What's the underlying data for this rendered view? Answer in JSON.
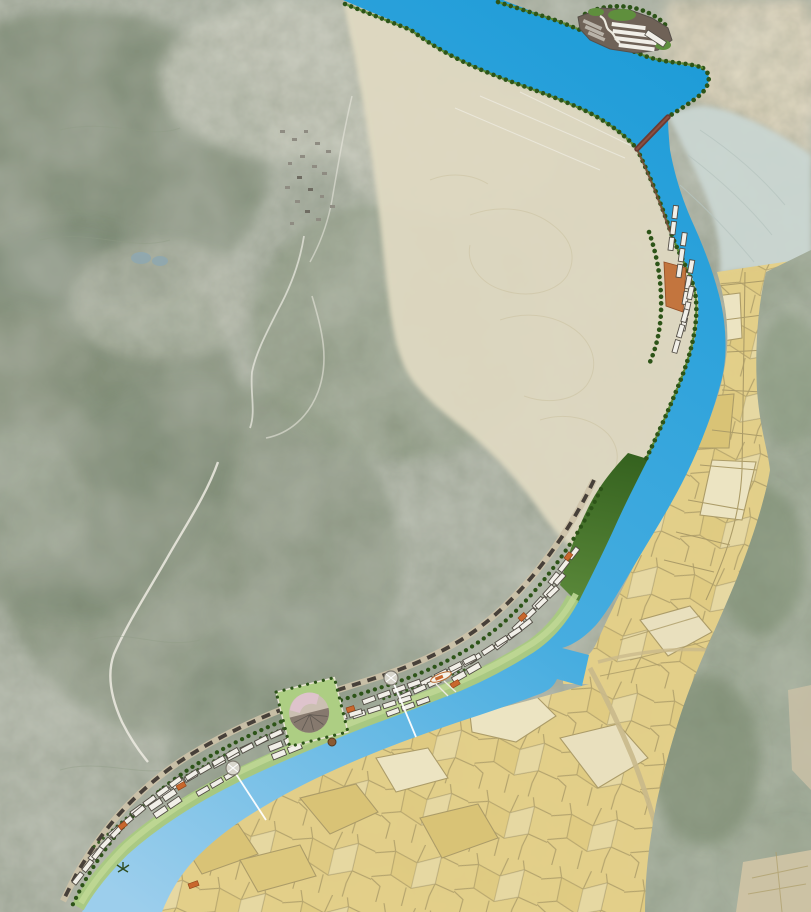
{
  "image_type": "aerial-masterplan-map",
  "description": "Aerial photo of mountainous river valley overlaid with a masterplan: reservoir and dam at top, river flowing southwest, tree-lined banks, a north lakeside settlement, a hillside cluster, a long linear waterfront town with central plaza, and yellow farmland/old-town parcels across the river",
  "water": {
    "reservoir": "reservoir",
    "river": "river channel",
    "inlet": "harbor inlet notch",
    "flow_direction": "north to southwest"
  },
  "features": {
    "structures": [
      "dam-crossing",
      "north-lakeside-settlement",
      "hillside-terrace-cluster",
      "linear-waterfront-town",
      "central-plaza-with-mound",
      "ferry-ship",
      "river-buoy",
      "waterfront-pier"
    ],
    "landscape": [
      "mountain-ridges",
      "hillside-village",
      "fish-ponds",
      "terraced-beige-fields",
      "pale-river-terraces",
      "farmland-parcels",
      "old-town-parcels",
      "shoreline-tree-lines",
      "riverbank-forest-band"
    ],
    "annotation": {
      "leader_lines": 2,
      "roundabout_nodes": 2,
      "leader_line_color": "#FFFFFF"
    }
  },
  "palette": {
    "terrain_base": "#A8AFA0",
    "terrain_light": "#C3C5B7",
    "terrain_forest": "#73836A",
    "terrain_forest2": "#66775E",
    "tan_hills": "#D8CDB3",
    "beige_fields": "#DFD9C1",
    "terrace_pale": "#CBD7D3",
    "hills_se": "#92A089",
    "corner_tan": "#CFC3A4",
    "parcel_yellow": "#E4D088",
    "parcel_deep": "#D9C376",
    "parcel_pale": "#ECE4C2",
    "parcel_line": "#AC9C68",
    "road_tan": "#C9B98B",
    "river_deep": "#1E9CD8",
    "river_mid": "#47ADE0",
    "river_light": "#9CCEEC",
    "tree_dark": "#2D5418",
    "tree_light": "#5C8F33",
    "lawn": "#A9CB7E",
    "lawn_bright": "#BFD795",
    "forest_band": "#3E6B28",
    "building_fill": "#F1EFE8",
    "building_stroke": "#524D45",
    "roof_dark": "#6F6257",
    "gray_row": "#B9B3A9",
    "accent_orange": "#C8672D",
    "dam_brown": "#6B3B33",
    "leader_white": "#FFFFFF",
    "node_fill": "#D8D6CC",
    "mound_pink": "#DEC3CE",
    "mound_base": "#CBBFB2",
    "plaza_green": "#ADCE83",
    "village_gray": "#8F8C82",
    "pond_gray": "#8FA8B0",
    "mountain_road": "#EDEBE2"
  }
}
